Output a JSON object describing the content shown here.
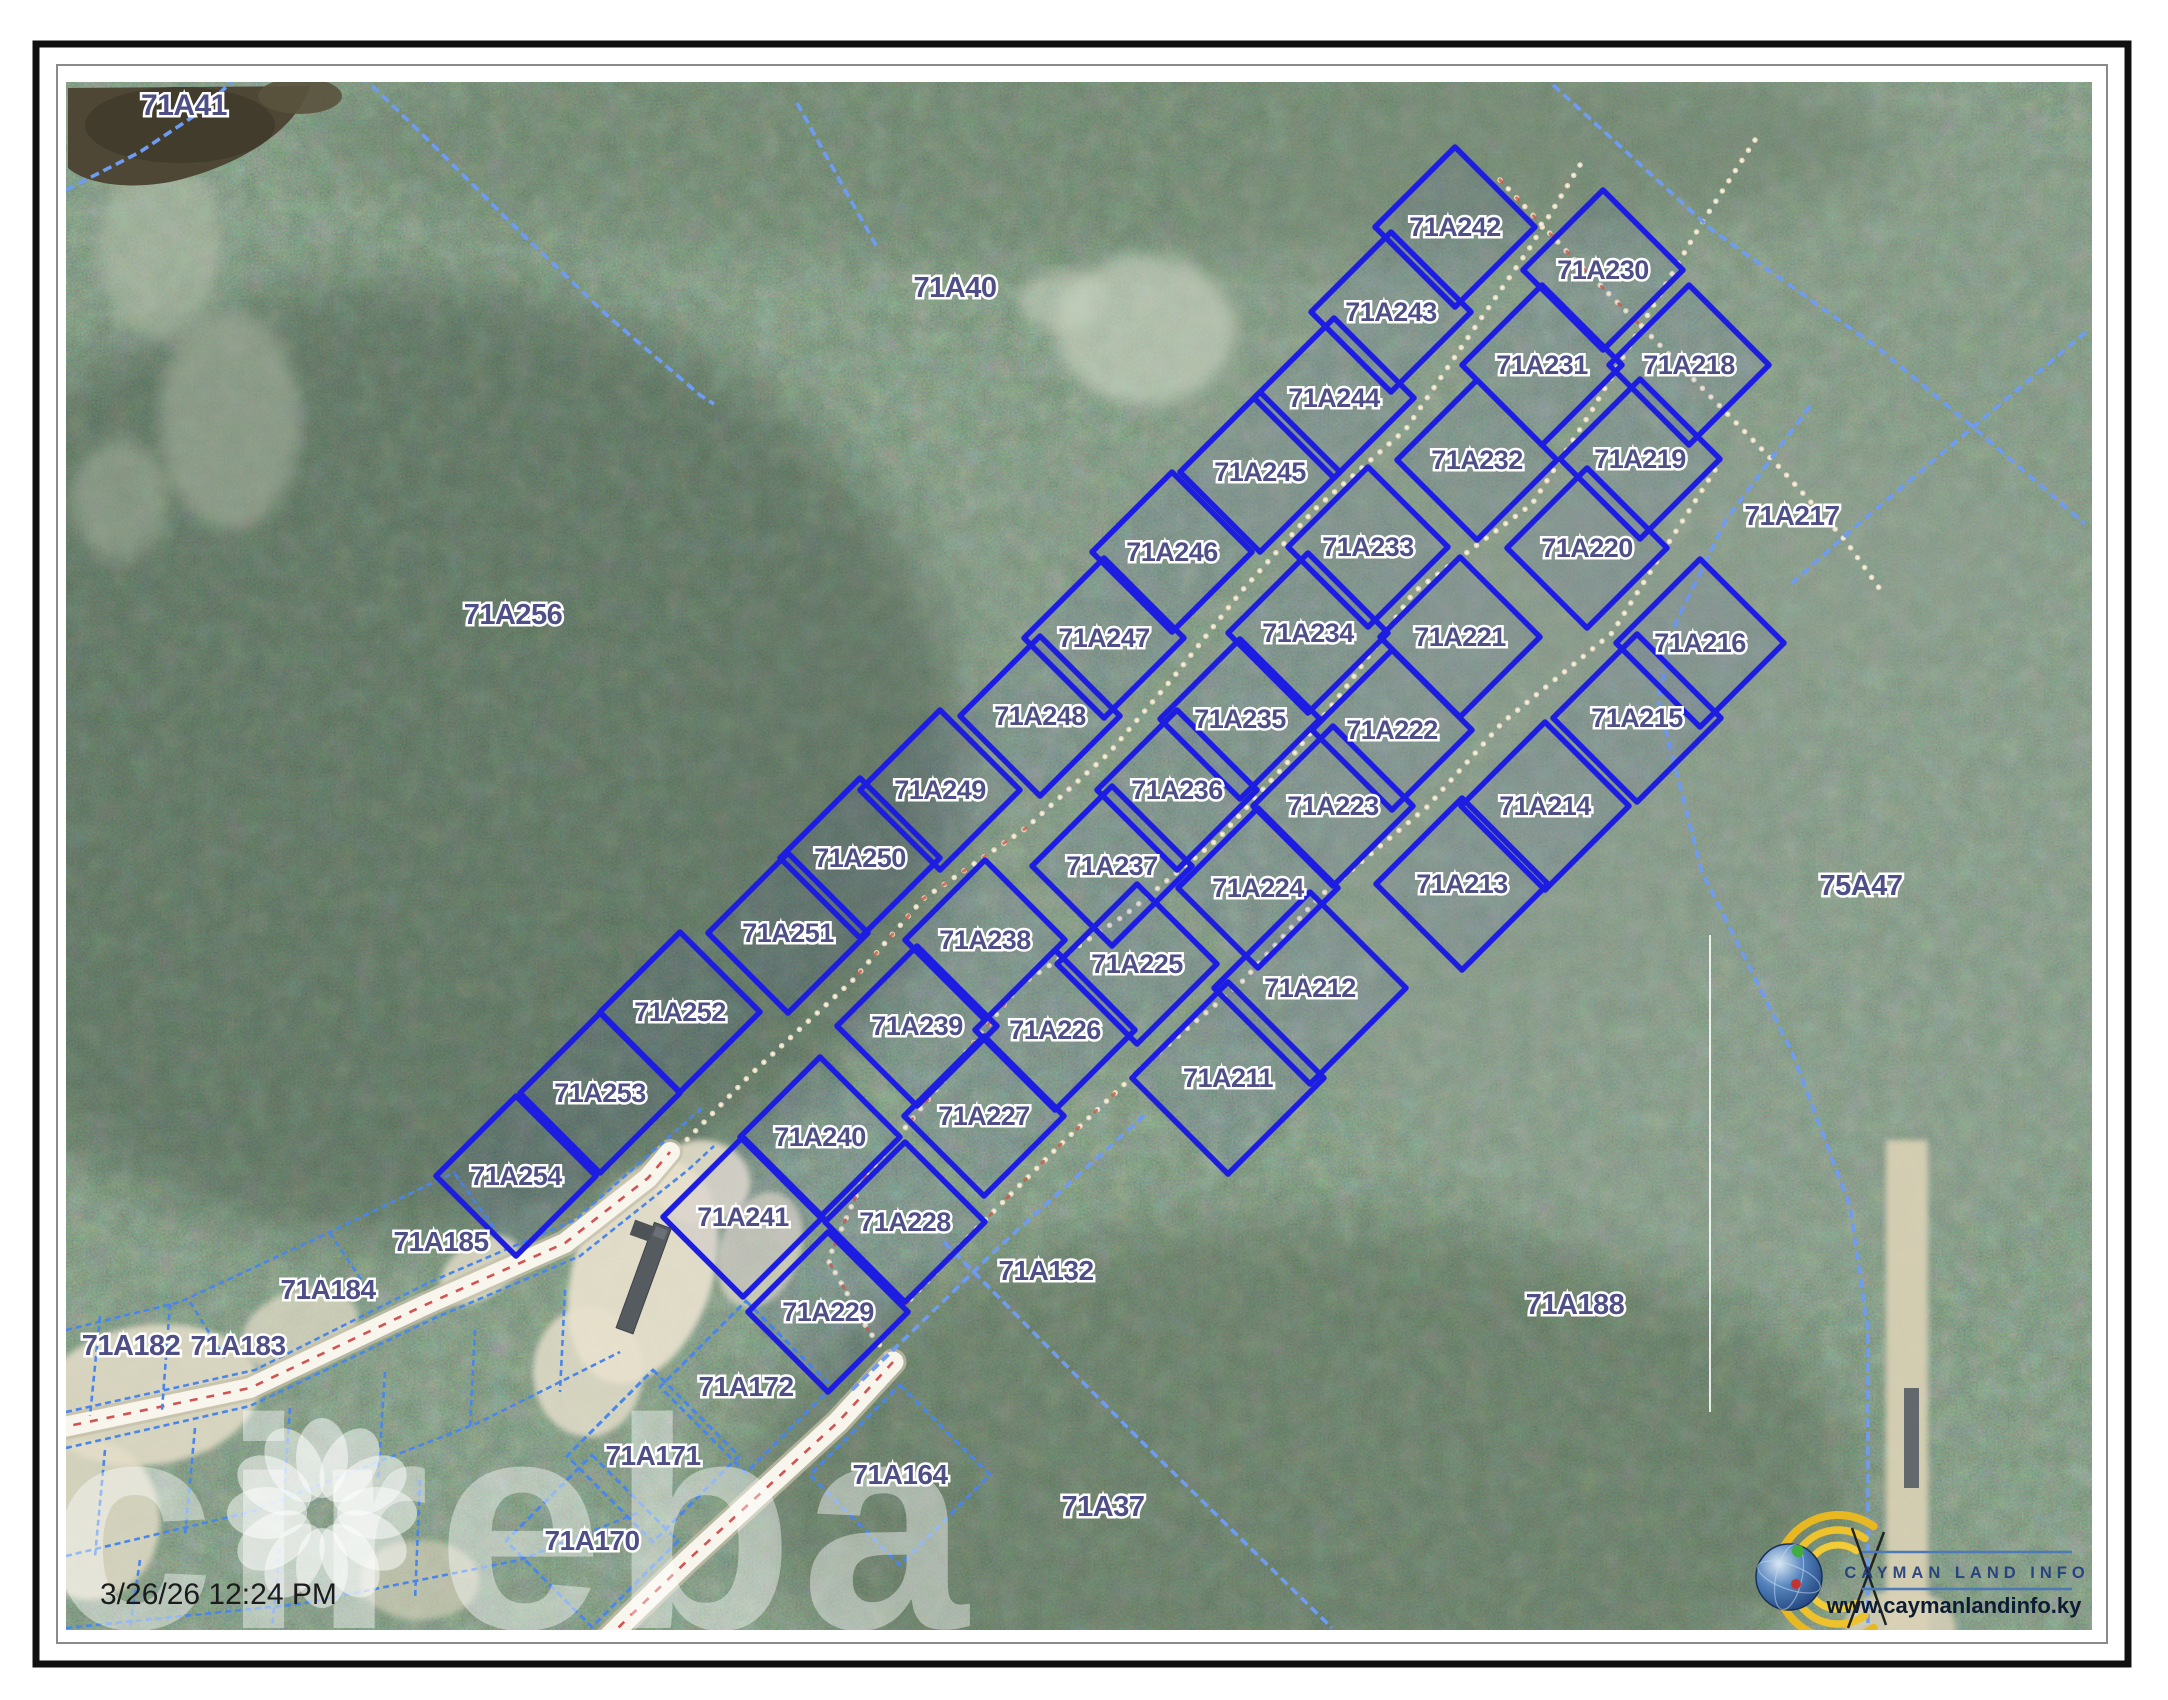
{
  "map": {
    "timestamp": "3/26/26 12:24 PM",
    "watermark": "cireba",
    "logo": {
      "title": "CAYMAN LAND INFO",
      "url": "www.caymanlandinfo.ky"
    },
    "colors": {
      "lot_stroke": "#1d1de2",
      "label_fill": "#4f4f88",
      "dashed_boundary": "#6f9cf2",
      "small_dashed": "#4a86ea",
      "trail_dots": "#e8dcc2",
      "road_fill": "#f7f5ec",
      "road_centerline": "#cf4040",
      "logo_yellow": "#e8b822",
      "logo_blue": "#1e3a7e"
    },
    "subdivision_lots": {
      "row1": [
        {
          "id": "71A242",
          "x": 1455,
          "y": 227
        },
        {
          "id": "71A243",
          "x": 1391,
          "y": 312
        },
        {
          "id": "71A244",
          "x": 1334,
          "y": 398
        },
        {
          "id": "71A245",
          "x": 1260,
          "y": 472
        },
        {
          "id": "71A246",
          "x": 1172,
          "y": 552
        },
        {
          "id": "71A247",
          "x": 1104,
          "y": 638
        },
        {
          "id": "71A248",
          "x": 1040,
          "y": 716
        },
        {
          "id": "71A249",
          "x": 940,
          "y": 790
        },
        {
          "id": "71A250",
          "x": 860,
          "y": 858
        },
        {
          "id": "71A251",
          "x": 788,
          "y": 933
        },
        {
          "id": "71A252",
          "x": 680,
          "y": 1012
        },
        {
          "id": "71A253",
          "x": 600,
          "y": 1093
        },
        {
          "id": "71A254",
          "x": 516,
          "y": 1176
        }
      ],
      "row2": [
        {
          "id": "71A230",
          "x": 1603,
          "y": 270
        },
        {
          "id": "71A231",
          "x": 1542,
          "y": 365
        },
        {
          "id": "71A232",
          "x": 1477,
          "y": 460
        },
        {
          "id": "71A233",
          "x": 1368,
          "y": 547
        },
        {
          "id": "71A234",
          "x": 1308,
          "y": 633
        },
        {
          "id": "71A235",
          "x": 1240,
          "y": 719
        },
        {
          "id": "71A236",
          "x": 1177,
          "y": 790
        },
        {
          "id": "71A237",
          "x": 1112,
          "y": 866
        },
        {
          "id": "71A238",
          "x": 985,
          "y": 940
        },
        {
          "id": "71A239",
          "x": 917,
          "y": 1026
        },
        {
          "id": "71A240",
          "x": 820,
          "y": 1137
        },
        {
          "id": "71A241",
          "x": 743,
          "y": 1217
        }
      ],
      "row3": [
        {
          "id": "71A218",
          "x": 1689,
          "y": 365
        },
        {
          "id": "71A219",
          "x": 1640,
          "y": 459
        },
        {
          "id": "71A220",
          "x": 1587,
          "y": 548
        },
        {
          "id": "71A221",
          "x": 1460,
          "y": 637
        },
        {
          "id": "71A222",
          "x": 1392,
          "y": 730
        },
        {
          "id": "71A223",
          "x": 1333,
          "y": 806
        },
        {
          "id": "71A224",
          "x": 1258,
          "y": 888
        },
        {
          "id": "71A225",
          "x": 1137,
          "y": 964
        },
        {
          "id": "71A226",
          "x": 1055,
          "y": 1030
        },
        {
          "id": "71A227",
          "x": 984,
          "y": 1116
        },
        {
          "id": "71A228",
          "x": 905,
          "y": 1222
        },
        {
          "id": "71A229",
          "x": 828,
          "y": 1312
        }
      ],
      "row4": [
        {
          "id": "71A216",
          "x": 1700,
          "y": 643,
          "d": 84
        },
        {
          "id": "71A215",
          "x": 1637,
          "y": 718,
          "d": 84
        },
        {
          "id": "71A214",
          "x": 1545,
          "y": 806,
          "d": 84
        },
        {
          "id": "71A213",
          "x": 1462,
          "y": 884,
          "d": 86
        },
        {
          "id": "71A212",
          "x": 1310,
          "y": 988,
          "d": 96
        },
        {
          "id": "71A211",
          "x": 1228,
          "y": 1078,
          "d": 96
        }
      ]
    },
    "outside_labels": [
      {
        "id": "71A41",
        "x": 184,
        "y": 106,
        "size": 30
      },
      {
        "id": "71A40",
        "x": 955,
        "y": 288,
        "size": 29
      },
      {
        "id": "71A256",
        "x": 513,
        "y": 615,
        "size": 29
      },
      {
        "id": "71A217",
        "x": 1792,
        "y": 516,
        "size": 28
      },
      {
        "id": "75A47",
        "x": 1861,
        "y": 886,
        "size": 29
      },
      {
        "id": "71A132",
        "x": 1046,
        "y": 1271,
        "size": 28
      },
      {
        "id": "71A37",
        "x": 1103,
        "y": 1507,
        "size": 29
      },
      {
        "id": "71A188",
        "x": 1575,
        "y": 1305,
        "size": 29
      },
      {
        "id": "71A185",
        "x": 441,
        "y": 1242,
        "size": 28
      },
      {
        "id": "71A184",
        "x": 328,
        "y": 1290,
        "size": 28
      },
      {
        "id": "71A183",
        "x": 238,
        "y": 1346,
        "size": 28
      },
      {
        "id": "71A182",
        "x": 131,
        "y": 1346,
        "size": 29
      },
      {
        "id": "71A172",
        "x": 746,
        "y": 1387,
        "size": 28
      },
      {
        "id": "71A171",
        "x": 653,
        "y": 1456,
        "size": 28
      },
      {
        "id": "71A170",
        "x": 592,
        "y": 1541,
        "size": 28
      },
      {
        "id": "71A164",
        "x": 900,
        "y": 1475,
        "size": 28
      }
    ],
    "dashed_parcels": [
      {
        "ref": "71A172",
        "x": 746,
        "y": 1387,
        "d": 86
      },
      {
        "ref": "71A171",
        "x": 653,
        "y": 1456,
        "d": 86
      },
      {
        "ref": "71A170",
        "x": 592,
        "y": 1541,
        "d": 86
      },
      {
        "ref": "71A164",
        "x": 900,
        "y": 1475,
        "d": 90
      }
    ],
    "features": {
      "roads": [
        {
          "name": "road-west",
          "width": 20,
          "pts": [
            [
              40,
              1432
            ],
            [
              250,
              1388
            ],
            [
              425,
              1305
            ],
            [
              565,
              1243
            ],
            [
              648,
              1178
            ],
            [
              670,
              1152
            ]
          ]
        },
        {
          "name": "road-south",
          "width": 21,
          "pts": [
            [
              893,
              1362
            ],
            [
              838,
              1422
            ],
            [
              788,
              1468
            ],
            [
              738,
              1514
            ],
            [
              688,
              1560
            ],
            [
              628,
              1618
            ],
            [
              596,
              1650
            ]
          ]
        }
      ],
      "trails": [
        {
          "name": "trail-nw-corridor",
          "pts": [
            [
              1580,
              165
            ],
            [
              1529,
              249
            ],
            [
              1467,
              339
            ],
            [
              1406,
              429
            ],
            [
              1314,
              510
            ],
            [
              1240,
              593
            ],
            [
              1172,
              679
            ],
            [
              1109,
              753
            ],
            [
              1026,
              828
            ],
            [
              923,
              899
            ],
            [
              853,
              980
            ],
            [
              750,
              1075
            ],
            [
              672,
              1155
            ]
          ]
        },
        {
          "name": "trail-main-corridor",
          "pts": [
            [
              1755,
              140
            ],
            [
              1700,
              226
            ],
            [
              1646,
              318
            ],
            [
              1591,
              412
            ],
            [
              1532,
              504
            ],
            [
              1414,
              592
            ],
            [
              1350,
              682
            ],
            [
              1287,
              763
            ],
            [
              1218,
              839
            ],
            [
              1125,
              915
            ],
            [
              1020,
              985
            ],
            [
              951,
              1071
            ],
            [
              863,
              1180
            ],
            [
              828,
              1260
            ],
            [
              868,
              1330
            ],
            [
              893,
              1362
            ]
          ]
        },
        {
          "name": "trail-se-corridor",
          "pts": [
            [
              1715,
              470
            ],
            [
              1664,
              550
            ],
            [
              1612,
              633
            ],
            [
              1503,
              722
            ],
            [
              1427,
              807
            ],
            [
              1319,
              897
            ],
            [
              1240,
              984
            ],
            [
              1150,
              1060
            ],
            [
              1060,
              1145
            ],
            [
              975,
              1230
            ],
            [
              905,
              1305
            ]
          ]
        },
        {
          "name": "trail-ne-cross",
          "pts": [
            [
              1500,
              180
            ],
            [
              1570,
              255
            ],
            [
              1640,
              325
            ],
            [
              1712,
              398
            ],
            [
              1782,
              470
            ],
            [
              1845,
              540
            ],
            [
              1882,
              592
            ]
          ]
        }
      ],
      "red_specks": [
        [
          [
            1026,
            828
          ],
          [
            923,
            899
          ],
          [
            853,
            980
          ]
        ],
        [
          [
            1020,
            985
          ],
          [
            951,
            1071
          ],
          [
            863,
            1180
          ],
          [
            828,
            1260
          ],
          [
            868,
            1330
          ]
        ],
        [
          [
            1150,
            1060
          ],
          [
            1060,
            1145
          ],
          [
            975,
            1230
          ],
          [
            905,
            1305
          ]
        ],
        [
          [
            1500,
            180
          ],
          [
            1570,
            255
          ],
          [
            1640,
            325
          ]
        ]
      ],
      "light_dashed_boundaries": [
        {
          "name": "pond-edge",
          "pts": [
            [
              66,
              190
            ],
            [
              140,
              152
            ],
            [
              200,
              112
            ],
            [
              248,
              66
            ]
          ]
        },
        {
          "name": "boundary-nw-long",
          "pts": [
            [
              352,
              66
            ],
            [
              430,
              142
            ],
            [
              520,
              232
            ],
            [
              610,
              318
            ],
            [
              700,
              395
            ],
            [
              714,
              404
            ]
          ]
        },
        {
          "name": "boundary-40-east",
          "pts": [
            [
              797,
              103
            ],
            [
              845,
              190
            ],
            [
              877,
              247
            ]
          ]
        },
        {
          "name": "boundary-ne-top",
          "pts": [
            [
              1553,
              85
            ],
            [
              1712,
              230
            ],
            [
              1877,
              347
            ],
            [
              1973,
              427
            ],
            [
              2085,
              524
            ]
          ]
        },
        {
          "name": "boundary-ne-cross",
          "pts": [
            [
              2086,
              332
            ],
            [
              1972,
              428
            ],
            [
              1856,
              526
            ],
            [
              1790,
              585
            ]
          ]
        },
        {
          "name": "boundary-east-long",
          "pts": [
            [
              1810,
              406
            ],
            [
              1726,
              520
            ],
            [
              1676,
              622
            ],
            [
              1658,
              700
            ],
            [
              1702,
              872
            ],
            [
              1792,
              1052
            ],
            [
              1850,
              1206
            ],
            [
              1868,
              1330
            ],
            [
              1868,
              1628
            ]
          ]
        },
        {
          "name": "boundary-132-nw",
          "pts": [
            [
              852,
              1390
            ],
            [
              1000,
              1246
            ],
            [
              1148,
              1112
            ]
          ]
        },
        {
          "name": "boundary-37-cross",
          "pts": [
            [
              944,
              1242
            ],
            [
              1140,
              1440
            ],
            [
              1332,
              1628
            ]
          ]
        }
      ],
      "small_dashed_lines": [
        [
          [
            66,
            1412
          ],
          [
            255,
            1370
          ],
          [
            430,
            1282
          ],
          [
            575,
            1220
          ],
          [
            668,
            1138
          ],
          [
            702,
            1108
          ]
        ],
        [
          [
            66,
            1448
          ],
          [
            250,
            1406
          ],
          [
            435,
            1318
          ],
          [
            580,
            1256
          ],
          [
            688,
            1170
          ],
          [
            714,
            1146
          ]
        ],
        [
          [
            66,
            1330
          ],
          [
            180,
            1302
          ],
          [
            330,
            1232
          ],
          [
            455,
            1172
          ]
        ],
        [
          [
            190,
            1302
          ],
          [
            225,
            1358
          ]
        ],
        [
          [
            330,
            1233
          ],
          [
            368,
            1290
          ]
        ],
        [
          [
            455,
            1174
          ],
          [
            497,
            1232
          ]
        ],
        [
          [
            100,
            1316
          ],
          [
            90,
            1416
          ]
        ],
        [
          [
            170,
            1304
          ],
          [
            162,
            1410
          ]
        ],
        [
          [
            66,
            1556
          ],
          [
            250,
            1512
          ],
          [
            480,
            1422
          ],
          [
            620,
            1352
          ]
        ],
        [
          [
            66,
            1628
          ],
          [
            300,
            1604
          ],
          [
            520,
            1560
          ],
          [
            640,
            1512
          ]
        ],
        [
          [
            105,
            1450
          ],
          [
            95,
            1556
          ]
        ],
        [
          [
            195,
            1428
          ],
          [
            185,
            1536
          ]
        ],
        [
          [
            290,
            1408
          ],
          [
            282,
            1520
          ]
        ],
        [
          [
            385,
            1372
          ],
          [
            378,
            1478
          ]
        ],
        [
          [
            475,
            1330
          ],
          [
            470,
            1428
          ]
        ],
        [
          [
            565,
            1290
          ],
          [
            560,
            1392
          ]
        ],
        [
          [
            140,
            1560
          ],
          [
            130,
            1628
          ]
        ],
        [
          [
            280,
            1548
          ],
          [
            272,
            1628
          ]
        ],
        [
          [
            420,
            1480
          ],
          [
            415,
            1600
          ]
        ]
      ],
      "white_survey_line": [
        [
          1710,
          935
        ],
        [
          1710,
          1412
        ]
      ]
    }
  }
}
